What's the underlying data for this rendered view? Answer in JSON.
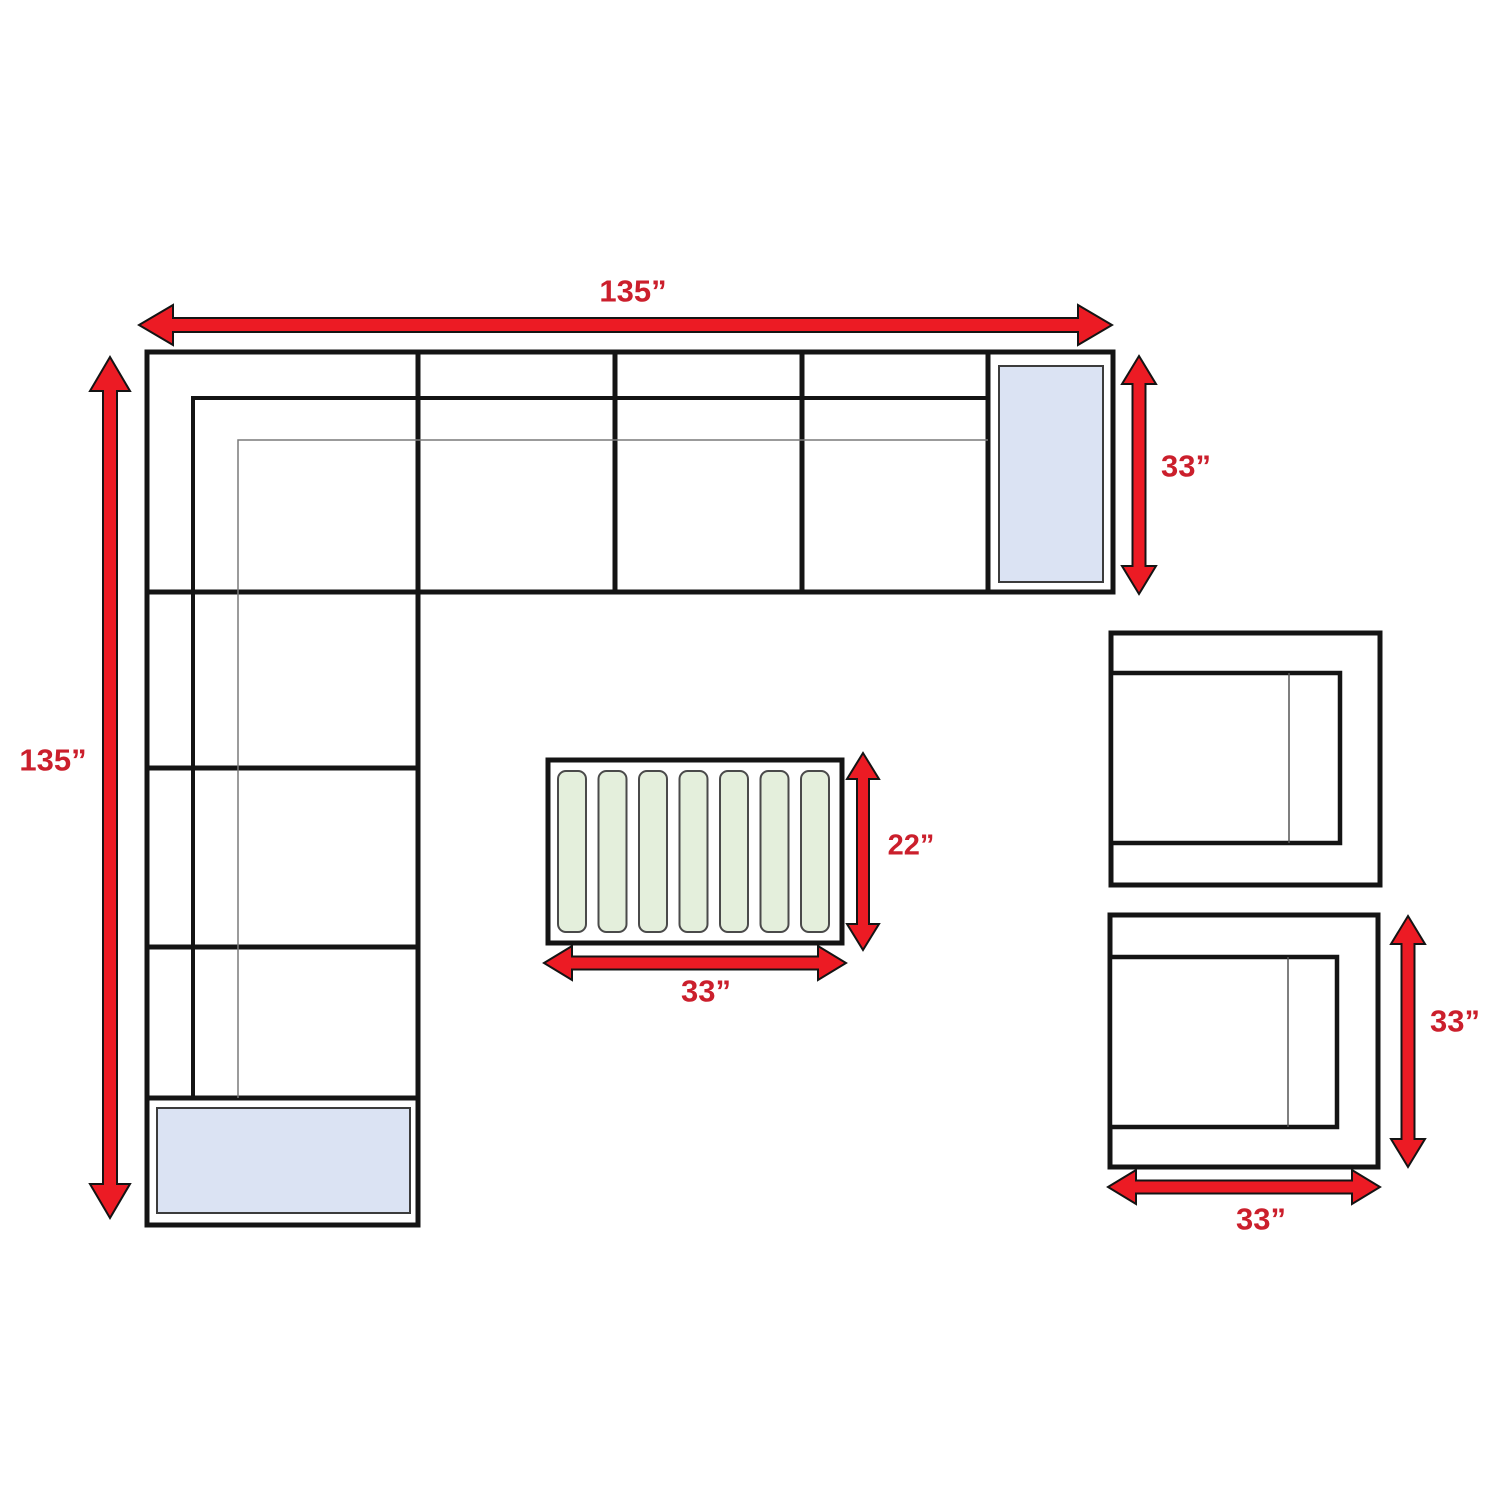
{
  "title": "Outdoor sectional furniture set dimension diagram",
  "colors": {
    "arrow_red": "#ec1b24",
    "label_red": "#cb1f2c",
    "outline_black": "#141414",
    "cushion_blue": "#dbe3f3",
    "slat_green": "#e4efdc",
    "thin_line_gray": "#7a7a7a",
    "background": "#ffffff"
  },
  "labels": {
    "sofa_width_top": "135”",
    "sofa_length_left": "135”",
    "sofa_depth_right": "33”",
    "table_depth": "22”",
    "table_width": "33”",
    "chair_height": "33”",
    "chair_width": "33”"
  },
  "pieces": {
    "sectional_sofa": "L-shaped sectional sofa (135 in x 135 in, 33 in deep)",
    "coffee_table": "Slatted coffee table (33 in x 22 in)",
    "corner_tables": "2 blue end cushions / corner tables",
    "club_chairs": "2 club chairs (33 in x 33 in)"
  }
}
